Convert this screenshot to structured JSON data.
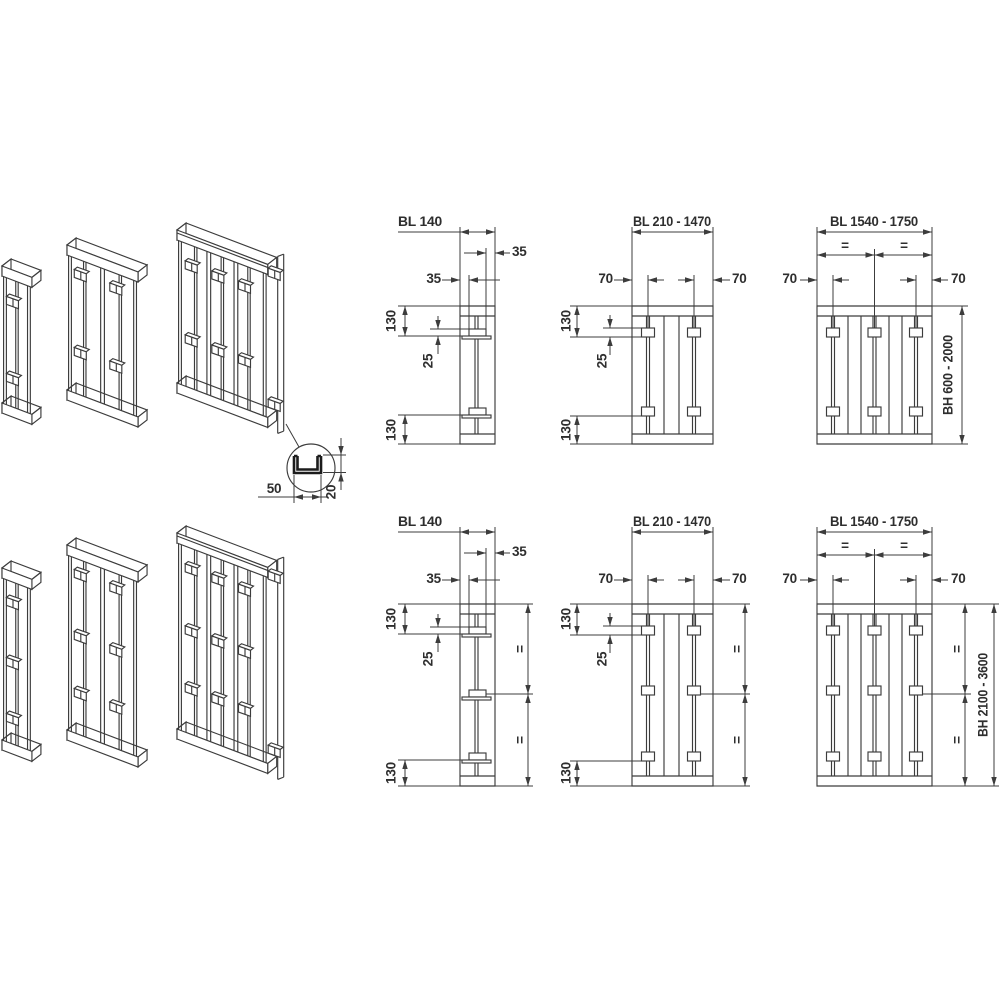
{
  "colors": {
    "line": "#3c3c3c",
    "text": "#2e2e2e",
    "background": "#ffffff"
  },
  "detail_callout": {
    "width": "50",
    "depth": "20"
  },
  "top_row": {
    "left": {
      "bl": "BL 140",
      "inset_right": "35",
      "inset_left": "35",
      "top_offset": "130",
      "hook_depth": "25",
      "bottom_offset": "130"
    },
    "middle": {
      "bl": "BL 210 - 1470",
      "offset_left": "70",
      "offset_right": "70",
      "top_offset": "130",
      "hook_depth": "25",
      "bottom_offset": "130"
    },
    "right": {
      "bl": "BL 1540 - 1750",
      "equal_left": "=",
      "equal_right": "=",
      "offset_left": "70",
      "offset_right": "70",
      "bh": "BH 600 - 2000"
    }
  },
  "bottom_row": {
    "left": {
      "bl": "BL 140",
      "inset_right": "35",
      "inset_left": "35",
      "top_offset": "130",
      "hook_depth": "25",
      "bottom_offset": "130",
      "equal_upper": "=",
      "equal_lower": "="
    },
    "middle": {
      "bl": "BL 210 - 1470",
      "offset_left": "70",
      "offset_right": "70",
      "top_offset": "130",
      "hook_depth": "25",
      "bottom_offset": "130",
      "equal_upper": "=",
      "equal_lower": "="
    },
    "right": {
      "bl": "BL 1540 - 1750",
      "equal_left": "=",
      "equal_right": "=",
      "offset_left": "70",
      "offset_right": "70",
      "bh": "BH 2100 - 3600",
      "equal_upper": "=",
      "equal_lower": "="
    }
  }
}
